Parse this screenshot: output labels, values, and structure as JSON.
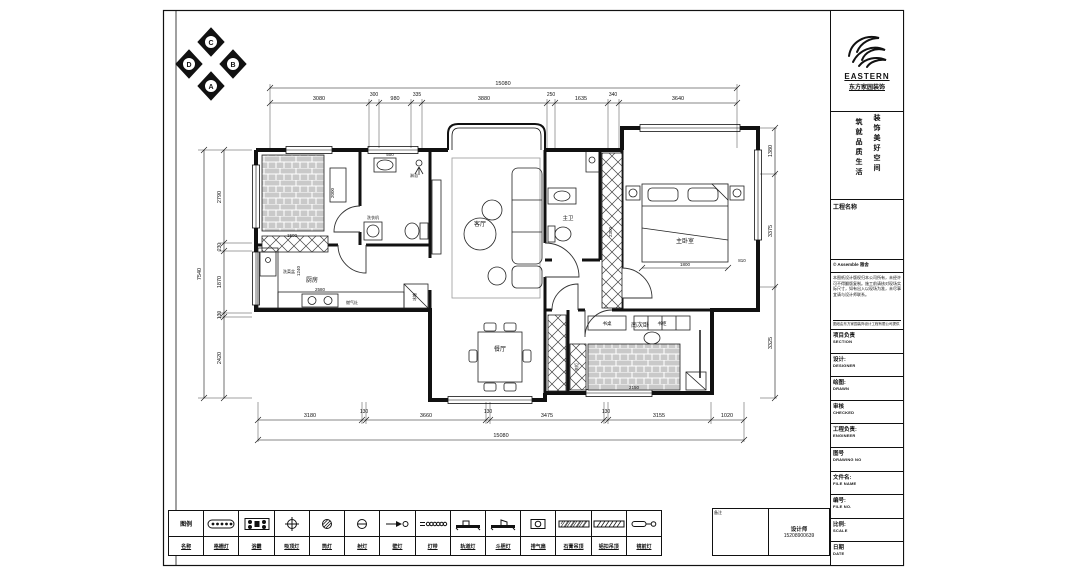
{
  "compass": {
    "top": "C",
    "right": "B",
    "bottom": "A",
    "left": "D"
  },
  "company": {
    "name": "EASTERN",
    "cn_name": "东方家园装饰",
    "slogan_right": "装饰美好空间",
    "slogan_left": "筑就品质生活"
  },
  "titleblock": {
    "project_label": "工程名称",
    "copyright": "© Assemble 雅舍",
    "notes": "本图纸设计版权归本公司所有，未经许可不得翻版复制。施工前请核对现场实际尺寸，如有出入以现场为准，未尽事宜请与设计师联系。",
    "notes_footer": "图纸由东方家园装饰设计工程有限公司提供",
    "rows": [
      {
        "cn": "项目负责",
        "en": "SECTION"
      },
      {
        "cn": "设计:",
        "en": "DESIGNER"
      },
      {
        "cn": "绘图:",
        "en": "DRAWN"
      },
      {
        "cn": "审核",
        "en": "CHECKED"
      },
      {
        "cn": "工程负责:",
        "en": "ENGINEER"
      },
      {
        "cn": "图号",
        "en": "DRAWING NO"
      },
      {
        "cn": "文件名:",
        "en": "FILE NAME"
      },
      {
        "cn": "编号:",
        "en": "FILE NO."
      },
      {
        "cn": "比例:",
        "en": "SCALE"
      },
      {
        "cn": "日期",
        "en": "DATE"
      }
    ]
  },
  "contact": {
    "note_label": "备注",
    "designer": "设计师",
    "phone": "15208900639"
  },
  "rooms": {
    "living": "客厅",
    "kitchen": "厨房",
    "dining": "餐厅",
    "master_bath": "主卫",
    "master_bed": "主卧室",
    "south_bed": "南次卧"
  },
  "labels": {
    "washer": "洗衣机",
    "shower": "淋浴",
    "veg_sink": "洗菜盆",
    "stove": "燃气灶",
    "fridge": "冰箱",
    "desk": "书桌",
    "bookcase": "书柜",
    "wardrobe": "衣柜"
  },
  "dims": {
    "top_total": "15080",
    "top": [
      "3080",
      "300",
      "980",
      "335",
      "3880",
      "250",
      "1635",
      "340",
      "3640"
    ],
    "bottom": [
      "3180",
      "130",
      "3660",
      "130",
      "3475",
      "130",
      "3155",
      "1020"
    ],
    "bottom_total": "15080",
    "left_total": "7540",
    "left": [
      "2790",
      "230",
      "1870",
      "130",
      "2420"
    ],
    "right": [
      "1380",
      "3375",
      "3325"
    ],
    "inner": [
      "1500",
      "2000",
      "500",
      "2580",
      "1240",
      "2300",
      "1800",
      "810",
      "2150"
    ]
  },
  "legend": {
    "header_top": "图例",
    "header_bottom": "名称",
    "items": [
      {
        "label": "格栅灯"
      },
      {
        "label": "浴霸"
      },
      {
        "label": "吸顶灯"
      },
      {
        "label": "筒灯"
      },
      {
        "label": "射灯"
      },
      {
        "label": "壁灯"
      },
      {
        "label": "灯带"
      },
      {
        "label": "轨道灯"
      },
      {
        "label": "斗胆灯"
      },
      {
        "label": "排气扇"
      },
      {
        "label": "石膏吊顶"
      },
      {
        "label": "铝扣吊顶"
      },
      {
        "label": "镜前灯"
      }
    ]
  }
}
